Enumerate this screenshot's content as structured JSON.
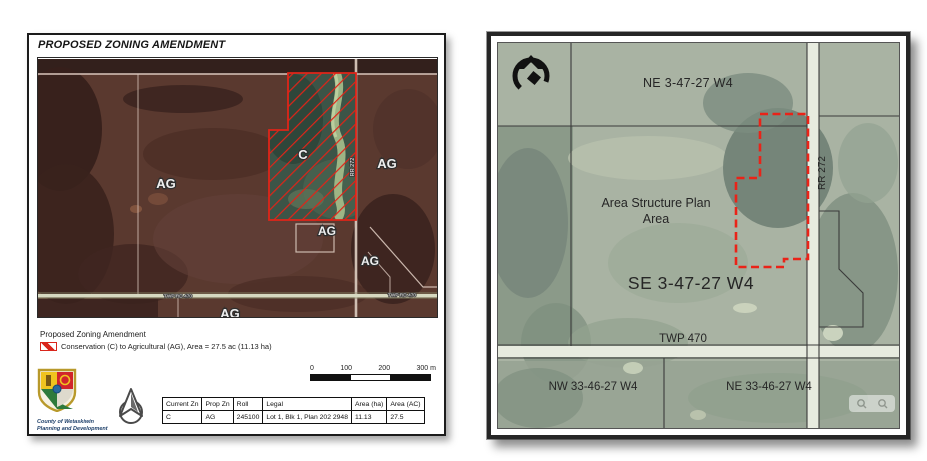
{
  "left_map": {
    "title": "PROPOSED ZONING AMENDMENT",
    "zone_labels": {
      "ag_west": "AG",
      "ag_east": "AG",
      "c_parcel": "C",
      "ag_south_small": "AG",
      "ag_southeast": "AG",
      "ag_bottom": "AG"
    },
    "road_labels": {
      "rr272": "RR 272",
      "twp_rd_470_left": "TWP RD 470",
      "twp_rd_470_right": "TWP RD 470"
    },
    "legend": {
      "heading": "Proposed Zoning Amendment",
      "item_label": "Conservation (C) to Agricultural (AG), Area = 27.5 ac (11.13 ha)"
    },
    "scale_bar": {
      "ticks": [
        "0",
        "100",
        "200",
        "300 m"
      ]
    },
    "logo": {
      "org_line1": "County of Wetaskiwin",
      "org_line2": "Planning and Development"
    },
    "table": {
      "headers": [
        "Current Zn",
        "Prop Zn",
        "Roll",
        "Legal",
        "Area (ha)",
        "Area (AC)"
      ],
      "rows": [
        [
          "C",
          "AG",
          "245100",
          "Lot 1, Blk 1, Plan 202 2948",
          "11.13",
          "27.5"
        ]
      ]
    },
    "colors": {
      "boundary_red": "#e02418"
    }
  },
  "right_map": {
    "labels": {
      "ne_quarter": "NE 3-47-27 W4",
      "asp_line1": "Area Structure Plan",
      "asp_line2": "Area",
      "se_quarter": "SE 3-47-27 W4",
      "twp_road": "TWP 470",
      "nw33_quarter": "NW 33-46-27 W4",
      "ne33_quarter": "NE 33-46-27 W4",
      "rr_road": "RR 272"
    },
    "colors": {
      "plan_boundary_red": "#ea2318"
    }
  }
}
